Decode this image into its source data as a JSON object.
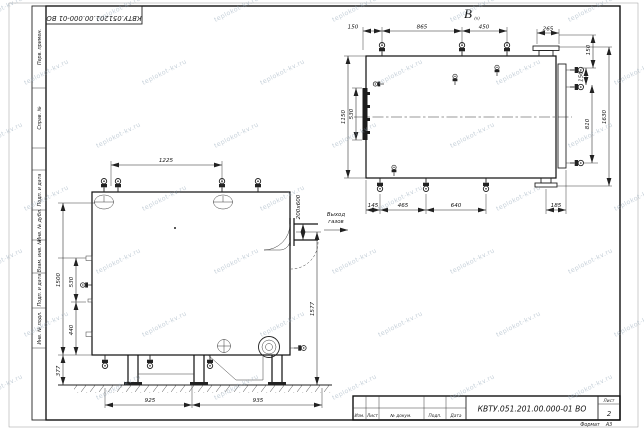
{
  "frame": {
    "top_stamp": "КВТУ.051201.00.000-01 ВО",
    "side_labels": [
      "Перв. примен.",
      "Справ. №",
      "Подп. и дата",
      "Инв. № дубл.",
      "Взам. инв. №",
      "Подп. и дата",
      "Инв. № подл."
    ]
  },
  "title_block": {
    "doc_number": "КВТУ.051.201.00.000-01 ВО",
    "cols": [
      "Изм.",
      "Лист",
      "№ докум.",
      "Подп.",
      "Дата"
    ],
    "sheet_label": "Лист",
    "sheet_value": "2",
    "format_label": "Формат",
    "format_value": "А3"
  },
  "front_view": {
    "dim_top": "1225",
    "dim_left": [
      "1500",
      "530",
      "440",
      "377"
    ],
    "dim_bottom": [
      "925",
      "935"
    ],
    "dim_right": "1577",
    "dim_flue": "200х600",
    "flue_label": [
      "Выход",
      "газов"
    ]
  },
  "top_view": {
    "label": "В",
    "label_sub": "(п)",
    "dim_top": [
      "150",
      "865",
      "450",
      "265",
      "150"
    ],
    "dim_right": [
      "150",
      "810",
      "1630"
    ],
    "dim_left": [
      "1150",
      "530"
    ],
    "dim_bottom": [
      "145",
      "465",
      "640",
      "185"
    ]
  },
  "watermark": {
    "text": "teplokot-kv.ru"
  },
  "colors": {
    "line": "#1a1a1a",
    "watermark": "#8fa3b5"
  }
}
